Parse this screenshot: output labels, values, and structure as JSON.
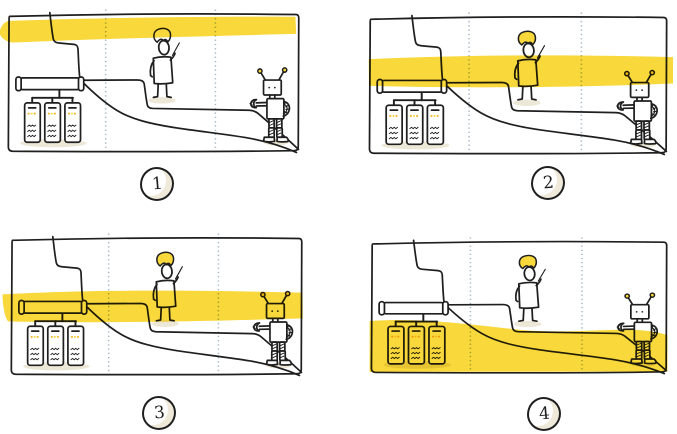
{
  "figure": {
    "panel_count": 4,
    "panels": [
      {
        "label": "1",
        "highlight_zone": "top"
      },
      {
        "label": "2",
        "highlight_zone": "upper-middle"
      },
      {
        "label": "3",
        "highlight_zone": "lower-middle"
      },
      {
        "label": "4",
        "highlight_zone": "bottom"
      }
    ],
    "scene_icons": [
      "server-rack-icon",
      "network-pipe-icon",
      "person-icon",
      "robot-icon"
    ],
    "colors": {
      "highlight": "#F8D83A",
      "ink": "#1F1F1F",
      "divider_dots": "#A7B7C5",
      "shadow_beige": "#EDE7D7",
      "led": "#F4B41A",
      "background": "#FFFFFF"
    }
  }
}
